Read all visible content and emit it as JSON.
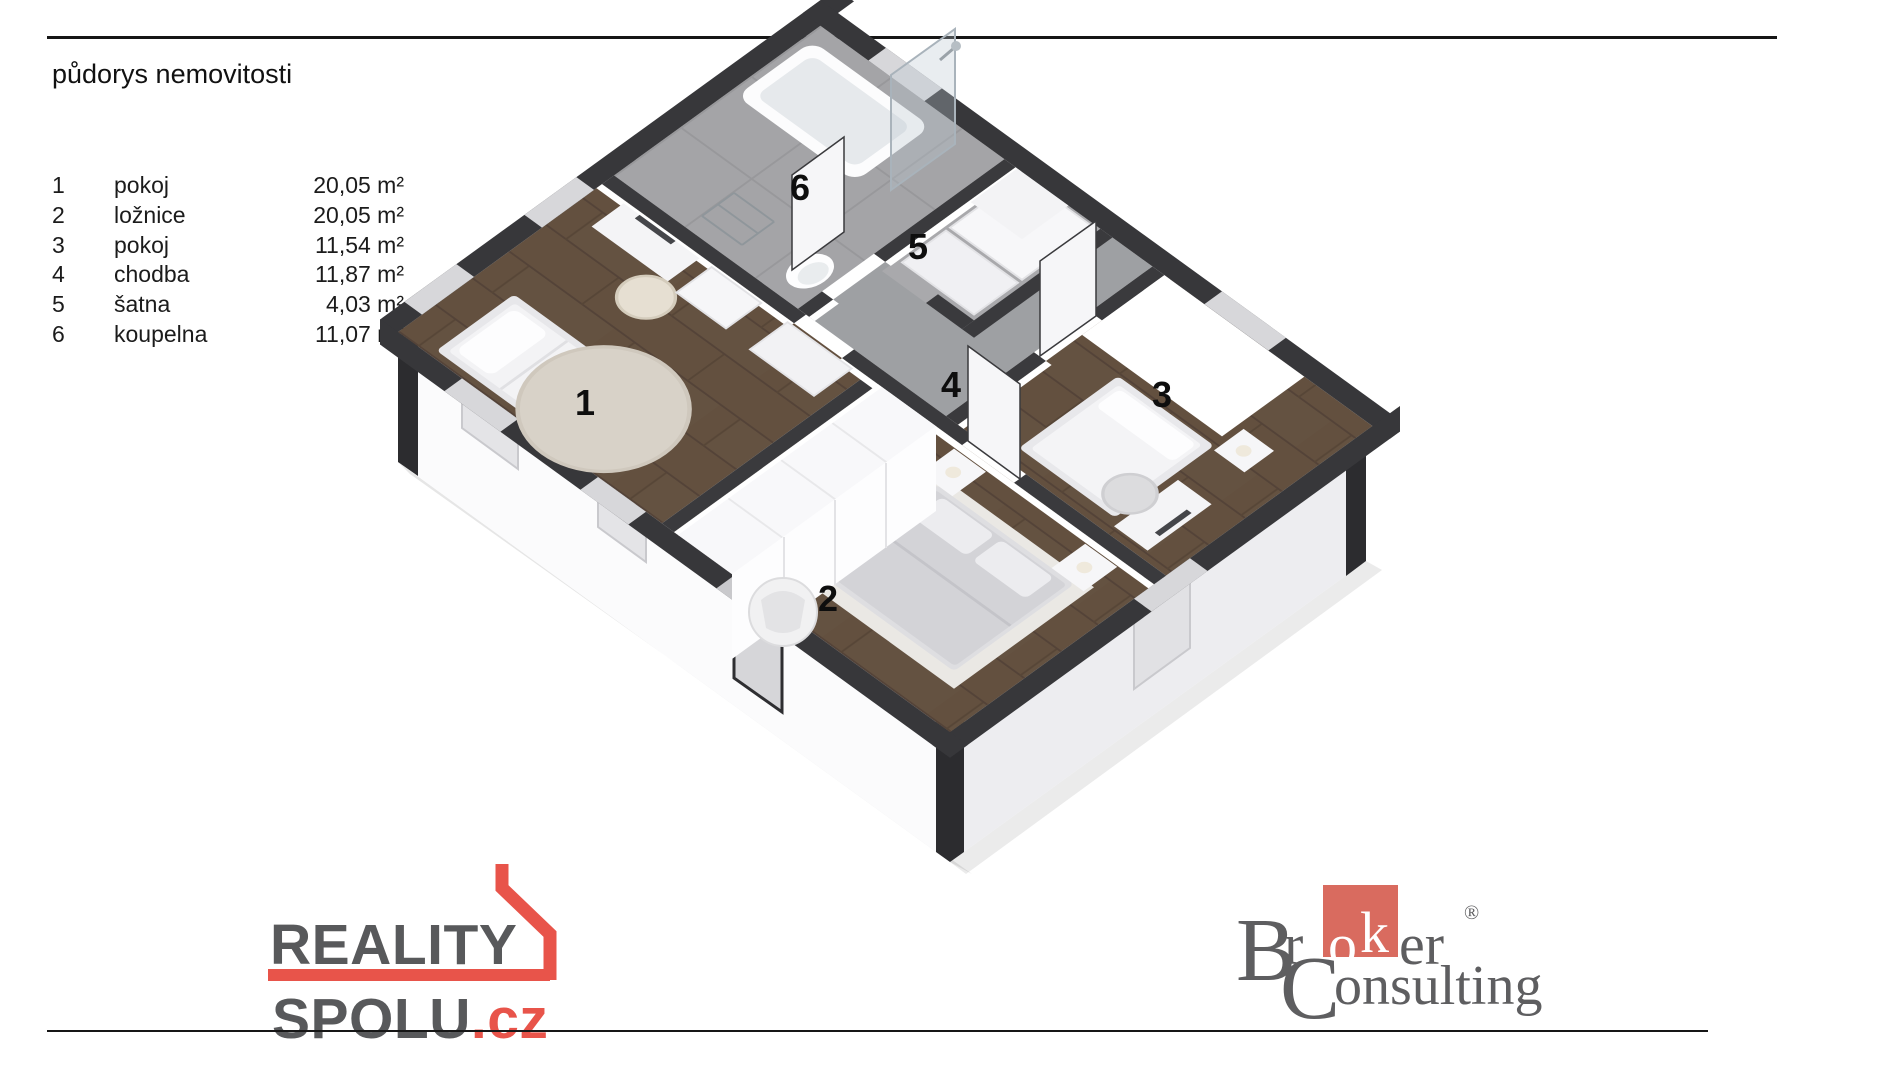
{
  "title": "půdorys nemovitosti",
  "legend": [
    {
      "num": "1",
      "name": "pokoj",
      "area": "20,05 m²"
    },
    {
      "num": "2",
      "name": "ložnice",
      "area": "20,05 m²"
    },
    {
      "num": "3",
      "name": "pokoj",
      "area": "11,54 m²"
    },
    {
      "num": "4",
      "name": "chodba",
      "area": "11,87 m²"
    },
    {
      "num": "5",
      "name": "šatna",
      "area": "4,03 m²"
    },
    {
      "num": "6",
      "name": "koupelna",
      "area": "11,07 m²"
    }
  ],
  "plan_labels": {
    "r1": "1",
    "r2": "2",
    "r3": "3",
    "r4": "4",
    "r5": "5",
    "r6": "6"
  },
  "footer": {
    "reality": {
      "line1": "REALITY",
      "line2": "SPOLU",
      "tld": ".cz"
    },
    "broker": {
      "b": "B",
      "r": "r",
      "o": "o",
      "k": "k",
      "er": "er",
      "reg": "®",
      "c": "C",
      "onsulting": "onsulting"
    }
  },
  "colors": {
    "reality_red": "#e8544a",
    "reality_gray": "#58595b",
    "broker_red": "#d96b5f",
    "broker_gray": "#5e5e60",
    "wall_dark": "#37373a",
    "wood_floor": "#63503f",
    "tile_gray": "#a4a4a7"
  }
}
